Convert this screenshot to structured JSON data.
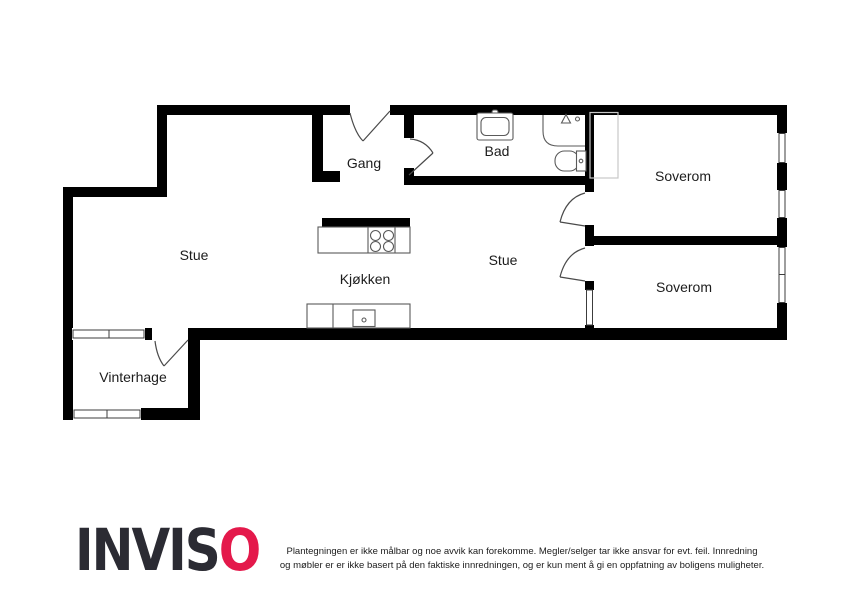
{
  "rooms": {
    "stue_left": "Stue",
    "gang": "Gang",
    "bad": "Bad",
    "soverom_top": "Soverom",
    "stue_right": "Stue",
    "kjokken": "Kjøkken",
    "soverom_bottom": "Soverom",
    "vinterhage": "Vinterhage"
  },
  "footer": {
    "logo_dark": "INVIS",
    "logo_accent": "O",
    "disclaimer_line1": "Plantegningen er ikke målbar og noe avvik kan forekomme. Megler/selger tar ikke ansvar for evt. feil. Innredning",
    "disclaimer_line2": "og møbler er er ikke basert på den faktiske innredningen, og er kun ment å gi en oppfatning av boligens muligheter."
  },
  "colors": {
    "wall": "#000000",
    "line": "#4a4a4a",
    "fixture": "#5a5a5a",
    "window": "#3c3c3c",
    "closet": "#c7c7c7",
    "logo_dark": "#2b2b33",
    "logo_accent": "#e4194b",
    "text": "#1c1c1c"
  }
}
